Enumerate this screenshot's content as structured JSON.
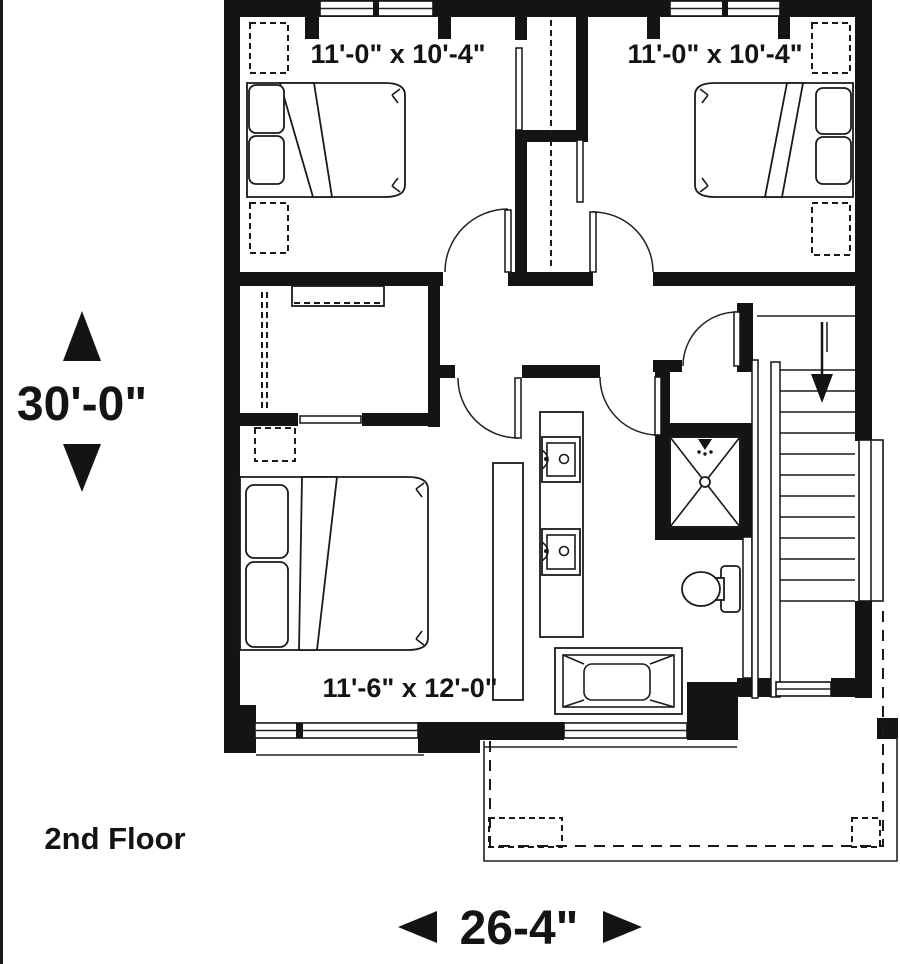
{
  "page": {
    "background": "#ffffff",
    "drawing_color": "#141414",
    "type": "architectural floor plan"
  },
  "labels": {
    "floor_name": "2nd Floor",
    "overall_depth": "30'-0\"",
    "overall_width": "26-4\"",
    "bedroom_top_left_size": "11'-0\" x 10'-4\"",
    "bedroom_top_right_size": "11'-0\" x 10'-4\"",
    "bedroom_bottom_size": "11'-6\" x 12'-0\""
  },
  "icons": {
    "up-arrow-icon": "solid triangle pointing up",
    "down-arrow-icon": "solid triangle pointing down",
    "left-arrow-icon": "solid triangle pointing left",
    "right-arrow-icon": "solid triangle pointing right",
    "stairs-down-arrow-icon": "thin arrow pointing down the stair run"
  },
  "fixtures": [
    "double-bed",
    "pillows",
    "closet-rod-dashed",
    "closet-shelf",
    "dresser",
    "double-vanity-sink",
    "shower-stall",
    "toilet",
    "bathtub",
    "stairs",
    "door-swing",
    "window",
    "porch-roof-outline",
    "porch-posts"
  ]
}
